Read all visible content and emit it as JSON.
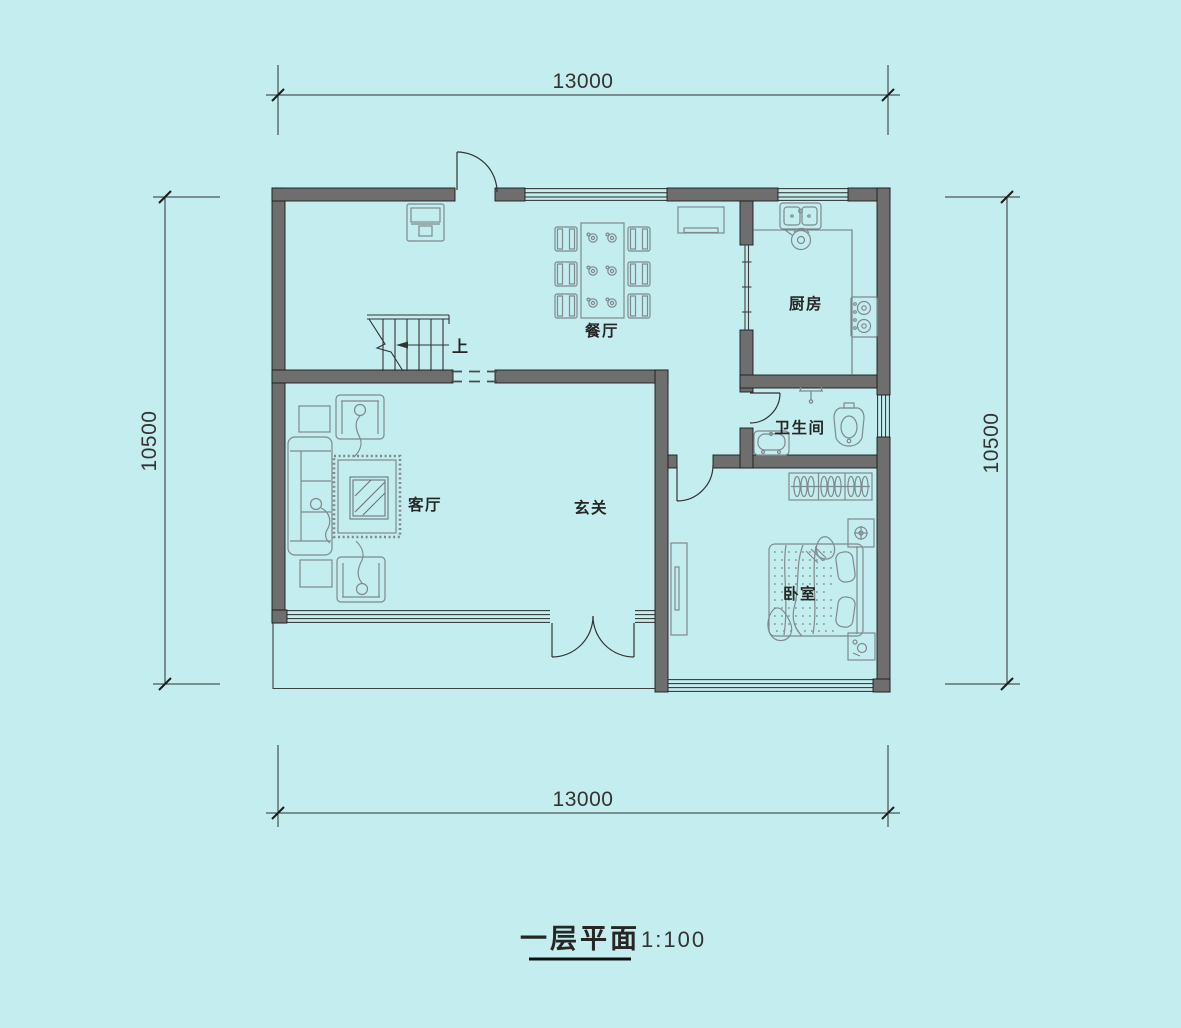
{
  "plan": {
    "title": "一层平面",
    "scale": "1:100",
    "rooms": {
      "dining": "餐厅",
      "kitchen": "厨房",
      "bathroom": "卫生间",
      "living": "客厅",
      "foyer": "玄关",
      "bedroom": "卧室"
    },
    "stairs_label": "上",
    "dims": {
      "top": "13000",
      "bottom": "13000",
      "left": "10500",
      "right": "10500"
    },
    "colors": {
      "background": "#c3edef",
      "wall_fill": "#6e6e6e",
      "wall_outline": "#1a1a1a",
      "drawing_line": "#2f2f2f",
      "furniture_line": "#7f8a8e"
    }
  }
}
